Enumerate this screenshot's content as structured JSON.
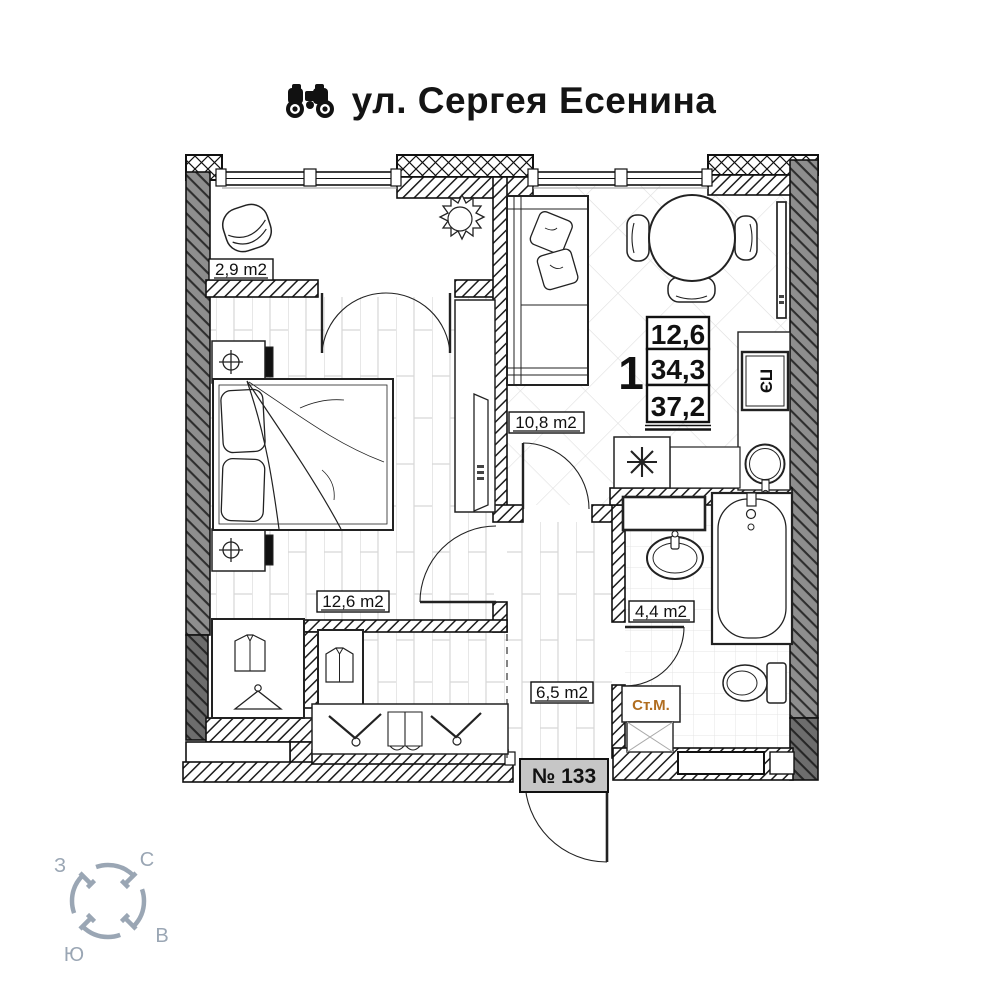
{
  "title": {
    "street": "ул. Сергея Есенина"
  },
  "rooms": {
    "balcony": {
      "label": "2,9 m2"
    },
    "bedroom": {
      "label": "12,6 m2"
    },
    "kitchen_living": {
      "label": "10,8 m2"
    },
    "hallway": {
      "label": "6,5 m2"
    },
    "bathroom": {
      "label": "4,4 m2"
    }
  },
  "stats": {
    "rooms_count": "1",
    "living_area": "12,6",
    "area_without_balcony": "34,3",
    "total_area": "37,2"
  },
  "appliances": {
    "stove_label": "ПЭ",
    "washing_machine_label": "Ст.М."
  },
  "entrance": {
    "apartment_number": "№ 133"
  },
  "compass": {
    "north": "С",
    "east": "В",
    "south": "Ю",
    "west": "З"
  },
  "colors": {
    "compass": "#9aa6b4",
    "washer_text": "#b06d20",
    "door_tag_bg": "#c6c6c6",
    "wall_dark": "#8e8e8e"
  }
}
